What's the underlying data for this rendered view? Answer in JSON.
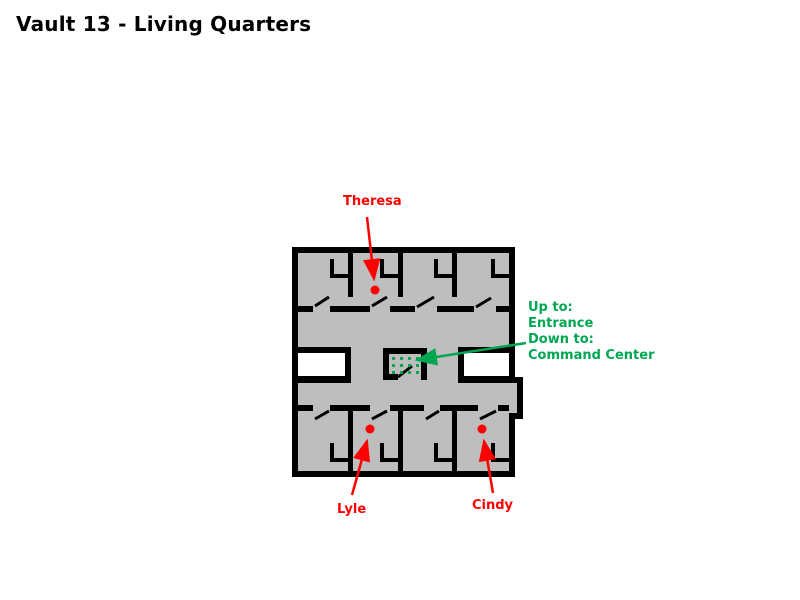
{
  "title": "Vault 13 - Living Quarters",
  "map": {
    "name": "Vault 13 living quarters floor plan",
    "resident_labels": [
      {
        "id": "theresa",
        "label": "Theresa"
      },
      {
        "id": "lyle",
        "label": "Lyle"
      },
      {
        "id": "cindy",
        "label": "Cindy"
      }
    ],
    "stairs_note": {
      "line1": "Up to:",
      "line2": "Entrance",
      "line3": "Down to:",
      "line4": "Command Center"
    },
    "legend": {
      "elevator_marker": "green dotted elevator/stairs pad",
      "resident_marker": "red dot"
    }
  },
  "colors": {
    "bg": "#FFFFFF",
    "floor": "#BEBEBE",
    "wall": "#000000",
    "marker-red": "#FF0000",
    "note-green": "#00A651",
    "void": "#FFFFFF"
  }
}
